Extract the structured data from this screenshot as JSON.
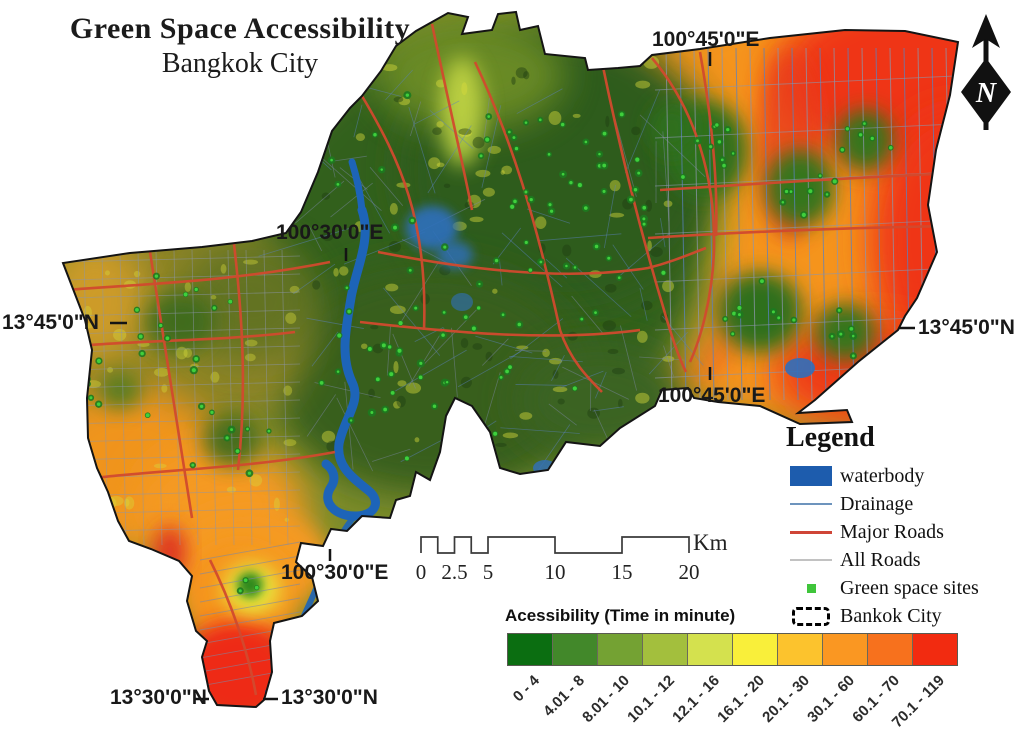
{
  "title": {
    "line1": "Green Space Accessibility",
    "line2": "Bangkok City"
  },
  "north_arrow": {
    "label": "N"
  },
  "graticule": {
    "top_lon": "100°45'0\"E",
    "upper_mid_lon": "100°30'0\"E",
    "left_lat": "13°45'0\"N",
    "right_lat": "13°45'0\"N",
    "mid_lon_east": "100°45'0\"E",
    "lower_mid_lon": "100°30'0\"E",
    "bottom_left_lat": "13°30'0\"N",
    "bottom_right_lat": "13°30'0\"N"
  },
  "legend": {
    "title": "Legend",
    "items": [
      {
        "label": "waterbody",
        "type": "fill",
        "color": "#1d5cad"
      },
      {
        "label": "Drainage",
        "type": "line",
        "color": "#6d94bd"
      },
      {
        "label": "Major Roads",
        "type": "line",
        "color": "#cf4537"
      },
      {
        "label": "All Roads",
        "type": "line",
        "color": "#c2c2c2"
      },
      {
        "label": "Green space sites",
        "type": "point",
        "color": "#3fc53b"
      },
      {
        "label": "Bankok City",
        "type": "boundary",
        "color": "#000000"
      }
    ]
  },
  "scale_bar": {
    "ticks": [
      "0",
      "2.5",
      "5",
      "10",
      "15",
      "20"
    ],
    "unit": "Km"
  },
  "ramp": {
    "title": "Acessibility (Time in minute)",
    "classes": [
      {
        "label": "0 - 4",
        "color": "#0b6e11"
      },
      {
        "label": "4.01 - 8",
        "color": "#42882a"
      },
      {
        "label": "8.01 - 10",
        "color": "#74a233"
      },
      {
        "label": "10.1 - 12",
        "color": "#a3bf3d"
      },
      {
        "label": "12.1 - 16",
        "color": "#d4e14e"
      },
      {
        "label": "16.1 - 20",
        "color": "#f9ef3a"
      },
      {
        "label": "20.1 - 30",
        "color": "#fcc32d"
      },
      {
        "label": "30.1 - 60",
        "color": "#fa9722"
      },
      {
        "label": "60.1 - 70",
        "color": "#f7711d"
      },
      {
        "label": "70.1 - 119",
        "color": "#f22b10"
      }
    ]
  }
}
